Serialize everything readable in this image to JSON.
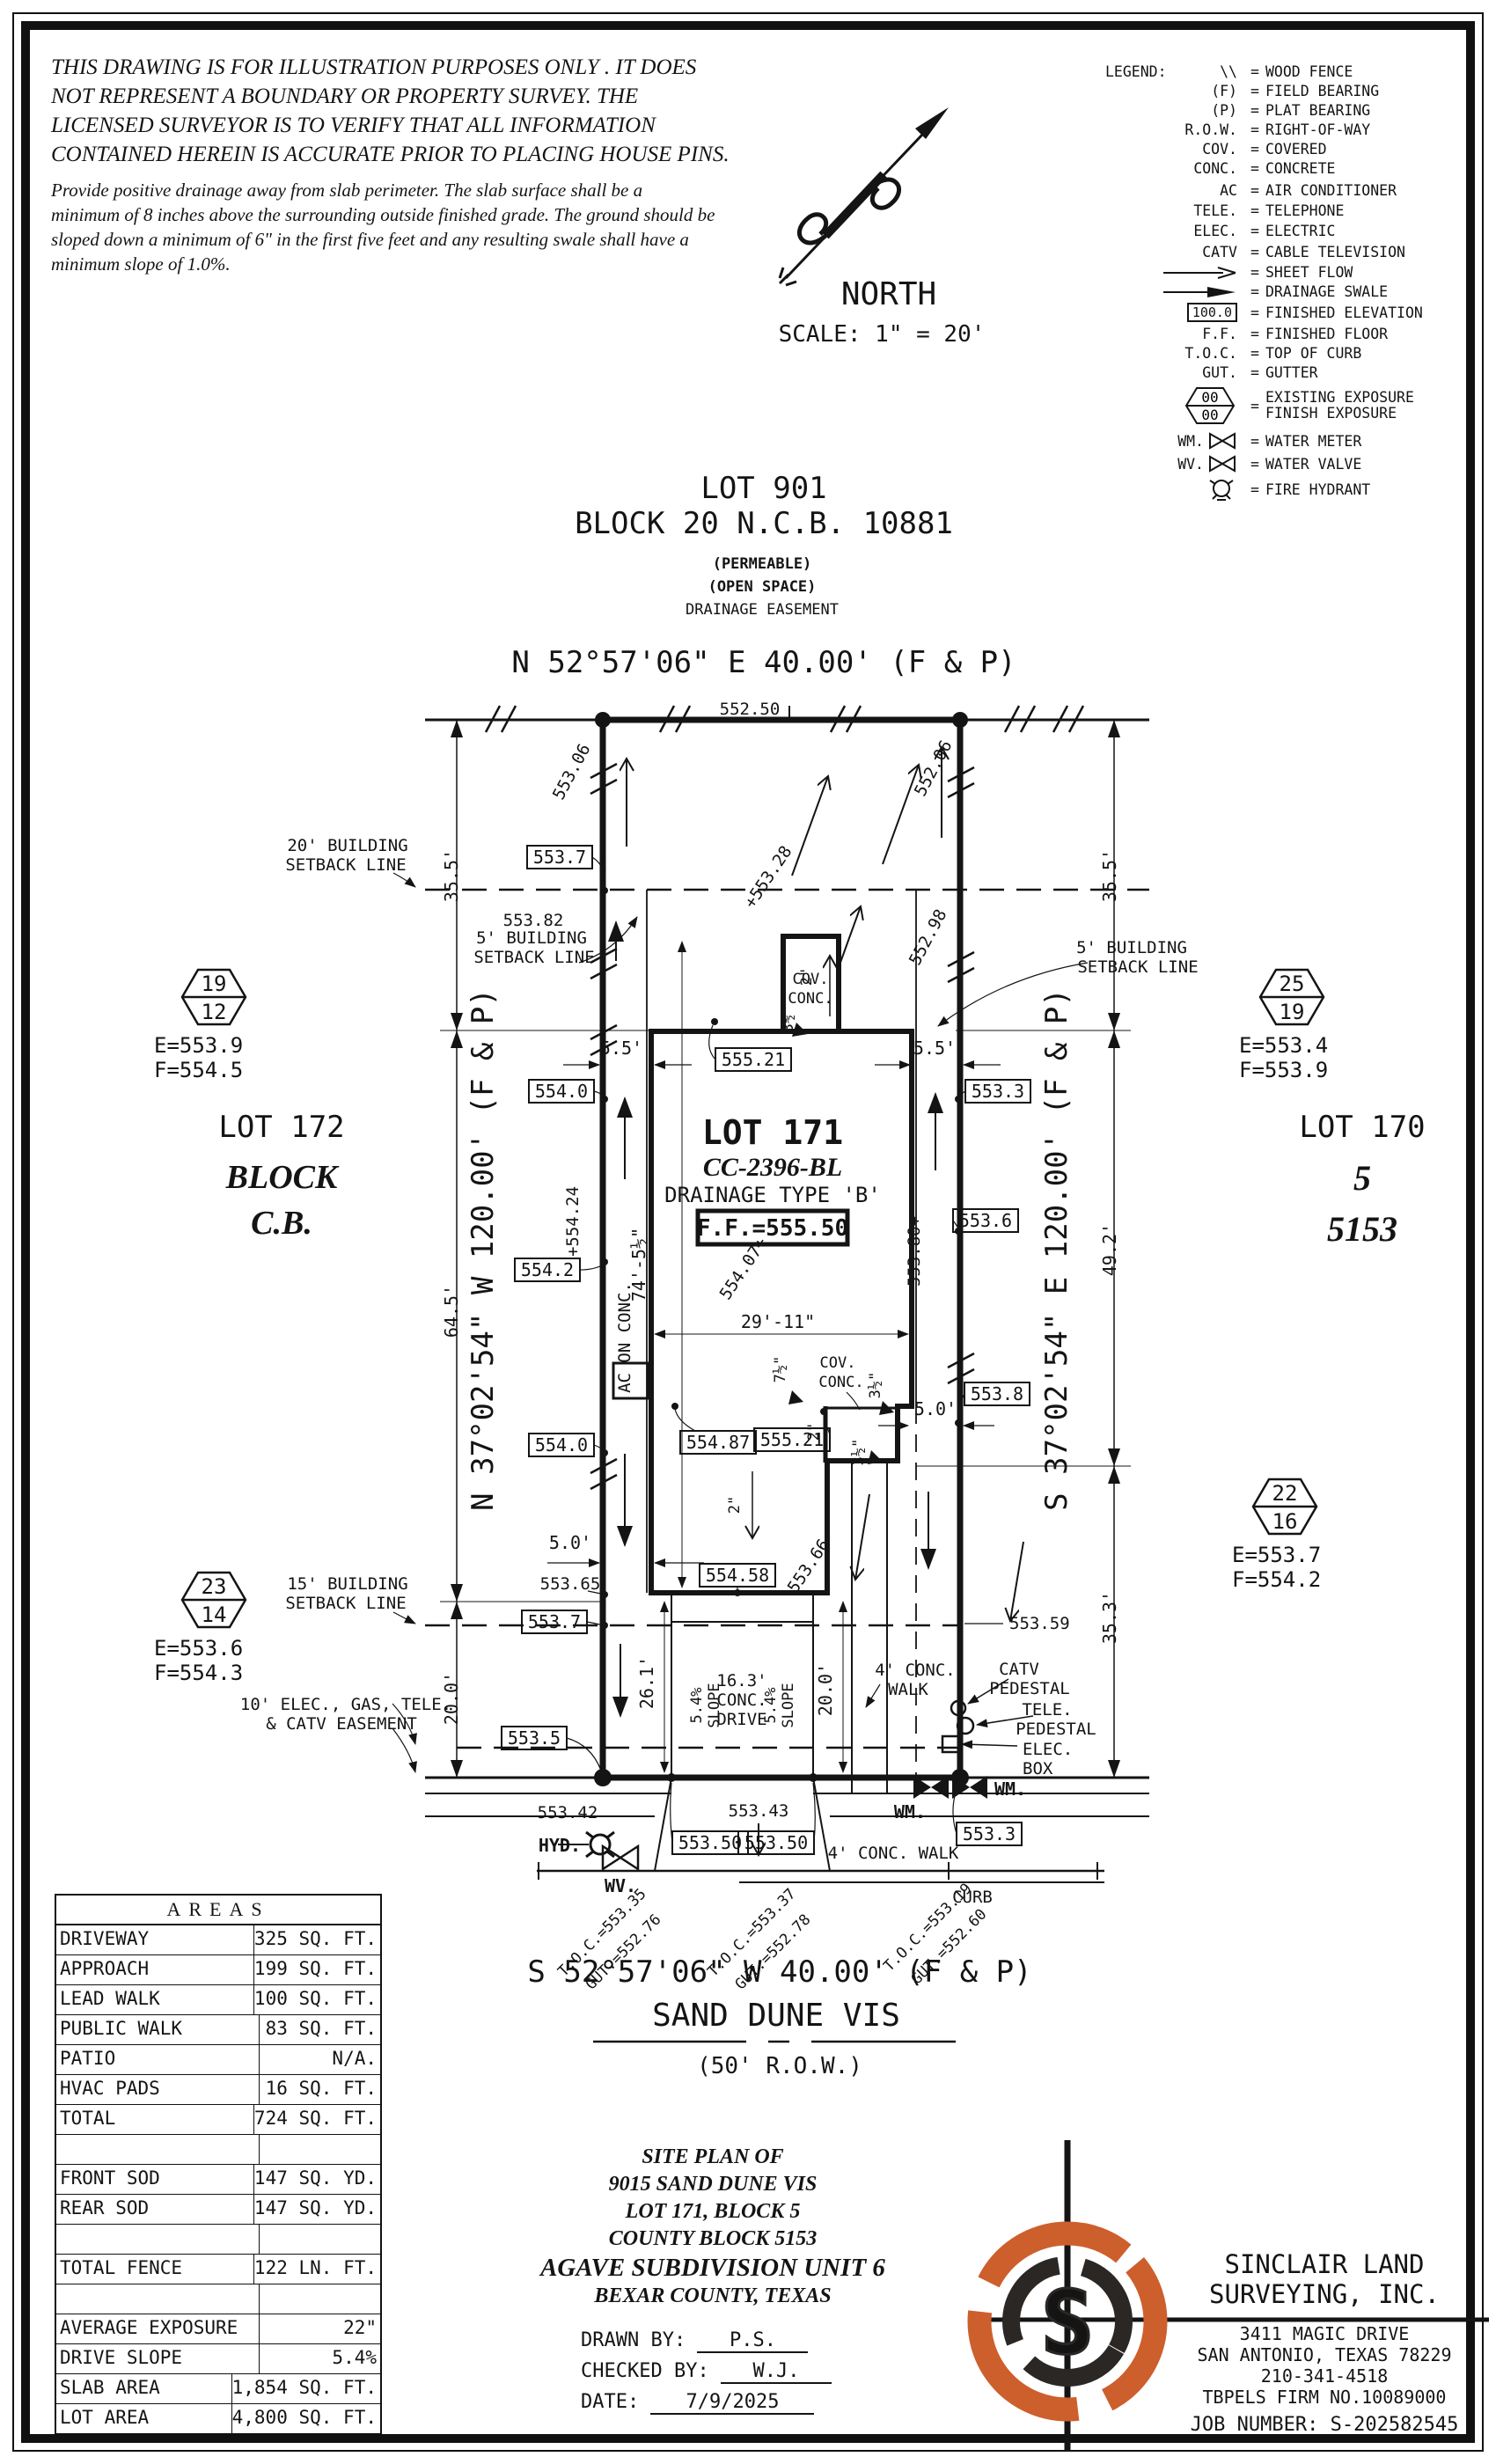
{
  "disclaimer": {
    "l1": "THIS DRAWING IS FOR ILLUSTRATION PURPOSES ONLY . IT DOES",
    "l2": "NOT REPRESENT A BOUNDARY OR PROPERTY SURVEY. THE",
    "l3": "LICENSED SURVEYOR IS TO VERIFY THAT ALL INFORMATION",
    "l4": "CONTAINED HEREIN IS ACCURATE PRIOR TO PLACING HOUSE PINS.",
    "p1": "Provide positive drainage away from slab perimeter. The slab surface shall be a",
    "p2": "minimum of 8 inches above the surrounding outside finished grade. The ground should be",
    "p3": "sloped down a minimum of 6\" in the first five feet and any resulting swale shall have a",
    "p4": "minimum slope of 1.0%."
  },
  "north": {
    "label": "NORTH",
    "scale": "SCALE: 1\" = 20'"
  },
  "legend": {
    "title": "LEGEND:",
    "items": [
      {
        "sym": "\\\\",
        "label": "WOOD FENCE"
      },
      {
        "sym": "(F)",
        "label": "FIELD BEARING"
      },
      {
        "sym": "(P)",
        "label": "PLAT BEARING"
      },
      {
        "sym": "R.O.W.",
        "label": "RIGHT-OF-WAY"
      },
      {
        "sym": "COV.",
        "label": "COVERED"
      },
      {
        "sym": "CONC.",
        "label": "CONCRETE"
      },
      {
        "sym": "AC",
        "label": "AIR CONDITIONER"
      },
      {
        "sym": "TELE.",
        "label": "TELEPHONE"
      },
      {
        "sym": "ELEC.",
        "label": "ELECTRIC"
      },
      {
        "sym": "CATV",
        "label": "CABLE TELEVISION"
      },
      {
        "sym": "",
        "label": "SHEET FLOW"
      },
      {
        "sym": "",
        "label": "DRAINAGE SWALE"
      },
      {
        "sym": "100.0",
        "label": "FINISHED ELEVATION"
      },
      {
        "sym": "F.F.",
        "label": "FINISHED FLOOR"
      },
      {
        "sym": "T.O.C.",
        "label": "TOP OF CURB"
      },
      {
        "sym": "GUT.",
        "label": "GUTTER"
      },
      {
        "sym_top": "00",
        "sym_bottom": "00",
        "label": "EXISTING EXPOSURE",
        "label2": "FINISH EXPOSURE"
      },
      {
        "sym": "WM.",
        "label": "WATER METER"
      },
      {
        "sym": "WV.",
        "label": "WATER VALVE"
      },
      {
        "sym": "",
        "label": "FIRE HYDRANT"
      }
    ]
  },
  "lot901": {
    "l1": "LOT 901",
    "l2": "BLOCK 20 N.C.B. 10881",
    "l3": "(PERMEABLE)",
    "l4": "(OPEN SPACE)",
    "l5": "DRAINAGE EASEMENT"
  },
  "bearings": {
    "north": "N 52°57'06\" E 40.00' (F & P)",
    "south": "S 52°57'06\" W 40.00' (F & P)",
    "west": "N 37°02'54\" W 120.00' (F & P)",
    "east": "S 37°02'54\" E 120.00' (F & P)"
  },
  "street": {
    "name": "SAND DUNE VIS",
    "row": "(50' R.O.W.)",
    "curb": "CURB"
  },
  "adjacent": {
    "left1": "LOT 172",
    "left2": "BLOCK",
    "left3": "C.B.",
    "right1": "LOT 170",
    "right2": "5",
    "right3": "5153"
  },
  "lot171": {
    "name": "LOT 171",
    "cc": "CC-2396-BL",
    "type": "DRAINAGE TYPE 'B'",
    "ff": "F.F.=555.50"
  },
  "hexagons": [
    {
      "top": "19",
      "bottom": "12",
      "e": "E=553.9",
      "f": "F=554.5"
    },
    {
      "top": "25",
      "bottom": "19",
      "e": "E=553.4",
      "f": "F=553.9"
    },
    {
      "top": "23",
      "bottom": "14",
      "e": "E=553.6",
      "f": "F=554.3"
    },
    {
      "top": "22",
      "bottom": "16",
      "e": "E=553.7",
      "f": "F=554.2"
    }
  ],
  "setbacks": {
    "s20a": "20' BUILDING",
    "s20b": "SETBACK LINE",
    "s5La": "5' BUILDING",
    "s5Lb": "SETBACK LINE",
    "s5Ra": "5' BUILDING",
    "s5Rb": "SETBACK LINE",
    "s15a": "15' BUILDING",
    "s15b": "SETBACK LINE",
    "easea": "10' ELEC., GAS, TELE.",
    "easeb": "& CATV EASEMENT"
  },
  "plan": {
    "boxed": [
      "553.7",
      "554.0",
      "554.2",
      "554.0",
      "553.7",
      "553.5",
      "553.3",
      "553.6",
      "553.8",
      "555.21",
      "554.87",
      "555.21",
      "554.58",
      "553.50",
      "553.50",
      "553.3"
    ],
    "spot": [
      "552.50",
      "553.06",
      "552.06",
      "+553.28",
      "552.98",
      "+554.24",
      "554.07+",
      "553.80+",
      "553.66",
      "553.65",
      "553.59",
      "553.42",
      "553.43",
      "553.82"
    ],
    "dims": [
      "35.5'",
      "64.5'",
      "20.0'",
      "35.5'",
      "49.2'",
      "35.3'",
      "5.5'",
      "5.5'",
      "5.0'",
      "5.0'",
      "29'-11\"",
      "74'-5½\"",
      "26.1'",
      "20.0'",
      "16.3'",
      "CONC.",
      "DRIVE",
      "5.4%",
      "SLOPE",
      "5.4%",
      "SLOPE",
      "2\"",
      "3½\"",
      "2\"",
      "7½\"",
      "3½\"",
      "2\"",
      "3½\""
    ]
  },
  "features": {
    "ac": "AC ON CONC.",
    "cov1a": "COV.",
    "cov1b": "CONC.",
    "cov2a": "COV.",
    "cov2b": "CONC.",
    "walk1a": "4' CONC.",
    "walk1b": "WALK",
    "walk2": "4' CONC. WALK",
    "curb": "CURB",
    "catv1": "CATV",
    "catv2": "PEDESTAL",
    "tele1": "TELE.",
    "tele2": "PEDESTAL",
    "elec1": "ELEC.",
    "elec2": "BOX",
    "hyd": "HYD.",
    "wv": "WV.",
    "wm1": "WM.",
    "wm2": "WM."
  },
  "toc": [
    {
      "toc": "T.O.C.=553.35",
      "gut": "GUT.=552.76"
    },
    {
      "toc": "T.O.C.=553.37",
      "gut": "GUT.=552.78"
    },
    {
      "toc": "T.O.C.=553.19",
      "gut": "GUT.=552.60"
    }
  ],
  "areas": {
    "title": "AREAS",
    "rows": [
      {
        "label": "DRIVEWAY",
        "value": "325 SQ. FT."
      },
      {
        "label": "APPROACH",
        "value": "199 SQ. FT."
      },
      {
        "label": "LEAD WALK",
        "value": "100 SQ. FT."
      },
      {
        "label": "PUBLIC WALK",
        "value": "83 SQ. FT."
      },
      {
        "label": "PATIO",
        "value": "N/A."
      },
      {
        "label": "HVAC PADS",
        "value": "16 SQ. FT."
      },
      {
        "label": "TOTAL",
        "value": "724 SQ. FT."
      },
      {
        "label": "",
        "value": ""
      },
      {
        "label": "FRONT SOD",
        "value": "147 SQ. YD."
      },
      {
        "label": "REAR SOD",
        "value": "147 SQ. YD."
      },
      {
        "label": "",
        "value": ""
      },
      {
        "label": "TOTAL FENCE",
        "value": "122 LN. FT."
      },
      {
        "label": "",
        "value": ""
      },
      {
        "label": "AVERAGE EXPOSURE",
        "value": "22\""
      },
      {
        "label": "DRIVE SLOPE",
        "value": "5.4%"
      },
      {
        "label": "SLAB AREA",
        "value": "1,854 SQ. FT."
      },
      {
        "label": "LOT AREA",
        "value": "4,800 SQ. FT."
      }
    ]
  },
  "titleblock": {
    "l0": "SITE PLAN OF",
    "l1": "9015 SAND DUNE VIS",
    "l2": "LOT 171, BLOCK 5",
    "l3": "COUNTY BLOCK 5153",
    "l4": "AGAVE SUBDIVISION UNIT 6",
    "l5": "BEXAR COUNTY, TEXAS",
    "drawn_label": "DRAWN BY:",
    "drawn": "P.S.",
    "checked_label": "CHECKED BY:",
    "checked": "W.J.",
    "date_label": "DATE:",
    "date": "7/9/2025"
  },
  "company": {
    "name1": "SINCLAIR LAND",
    "name2": "SURVEYING, INC.",
    "addr1": "3411 MAGIC DRIVE",
    "addr2": "SAN ANTONIO, TEXAS 78229",
    "phone": "210-341-4518",
    "firm": "TBPELS FIRM NO.10089000",
    "job": "JOB NUMBER:  S-202582545"
  },
  "colors": {
    "ink": "#141414",
    "logo_orange": "#cd5f2c",
    "logo_dark": "#2b2724"
  }
}
